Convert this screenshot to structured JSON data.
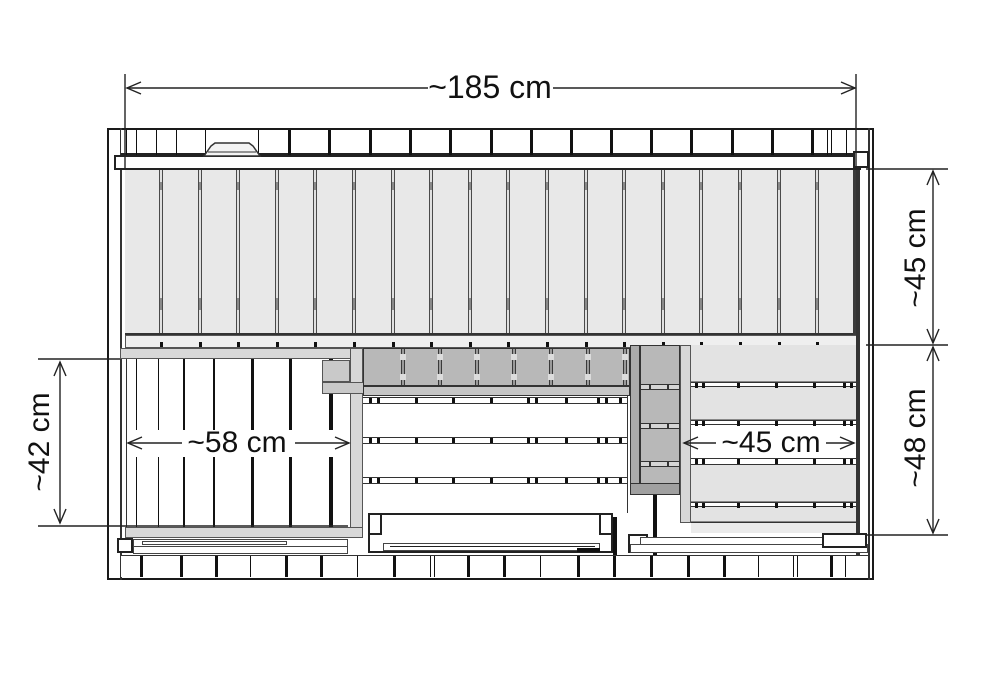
{
  "diagram": {
    "type": "technical-plan",
    "subject": "sauna-bench-layout-top-view",
    "units": "cm",
    "labels": {
      "overall_width": "~185 cm",
      "back_bench_depth": "~45 cm",
      "front_area_depth": "~48 cm",
      "left_bench_depth": "~42 cm",
      "left_bench_width": "~58 cm",
      "right_bench_width": "~45 cm"
    },
    "measurements_cm": {
      "overall_width": 185,
      "back_bench_depth": 45,
      "front_area_depth": 48,
      "left_bench_depth": 42,
      "left_bench_width": 58,
      "right_bench_width": 45
    },
    "colors": {
      "line": "#222222",
      "thin_line": "#444444",
      "plank_fill": "#e8e8e8",
      "groove": "#4a4a4a",
      "light_panel": "#d8d8d8",
      "mid_panel": "#c6c6c6",
      "dark_panel": "#b8b8b8",
      "rail_gray": "#ababab",
      "strip_light": "#efefef",
      "bench_bottom": "#a8a8a8",
      "white": "#ffffff"
    },
    "structure": {
      "top_studs": [
        [
          5,
          1
        ],
        [
          15,
          1
        ],
        [
          35,
          1
        ],
        [
          55,
          1
        ],
        [
          84,
          1
        ],
        [
          137,
          1
        ],
        [
          167,
          3
        ],
        [
          207,
          3
        ],
        [
          248,
          3
        ],
        [
          288,
          3
        ],
        [
          328,
          3
        ],
        [
          369,
          3
        ],
        [
          409,
          3
        ],
        [
          449,
          3
        ],
        [
          489,
          3
        ],
        [
          529,
          3
        ],
        [
          569,
          3
        ],
        [
          610,
          3
        ],
        [
          650,
          3
        ],
        [
          690,
          3
        ],
        [
          706,
          1
        ],
        [
          710,
          1
        ],
        [
          725,
          1
        ]
      ],
      "bottom_studs": [
        [
          19,
          3
        ],
        [
          59,
          3
        ],
        [
          94,
          3
        ],
        [
          129,
          1
        ],
        [
          164,
          3
        ],
        [
          199,
          3
        ],
        [
          236,
          1
        ],
        [
          272,
          3
        ],
        [
          309,
          1
        ],
        [
          313,
          1
        ],
        [
          346,
          3
        ],
        [
          382,
          3
        ],
        [
          419,
          1
        ],
        [
          456,
          3
        ],
        [
          492,
          3
        ],
        [
          529,
          3
        ],
        [
          566,
          3
        ],
        [
          602,
          3
        ],
        [
          637,
          1
        ],
        [
          672,
          1
        ],
        [
          676,
          1
        ],
        [
          709,
          3
        ],
        [
          724,
          1
        ]
      ],
      "planks": {
        "start": 34,
        "step": 38.6,
        "count": 18
      },
      "left_slats": [
        [
          9,
          1
        ],
        [
          31,
          1
        ],
        [
          56,
          2
        ],
        [
          86,
          2
        ],
        [
          124,
          3
        ],
        [
          162,
          3
        ],
        [
          202,
          4
        ]
      ],
      "left_slat_segments": [
        [
          0,
          71
        ],
        [
          98,
          70
        ]
      ],
      "backrest_grooves": [
        37,
        74,
        111,
        148,
        185,
        222,
        259
      ],
      "middle_gaps": [
        1,
        41,
        81
      ],
      "middle_gap_ticks": [
        6,
        14,
        52,
        89,
        127,
        164,
        172,
        202,
        234,
        242,
        256
      ],
      "heater_grooves": [
        38,
        77,
        115
      ],
      "right_slats": [
        [
          0,
          37
        ],
        [
          42,
          33
        ],
        [
          120,
          37
        ],
        [
          162,
          15
        ]
      ],
      "right_gaps": [
        [
          37,
          5
        ],
        [
          75,
          5
        ],
        [
          113,
          7
        ],
        [
          157,
          5
        ]
      ],
      "right_gap_ticks": [
        4,
        11,
        46,
        84,
        122,
        152,
        159
      ]
    }
  }
}
